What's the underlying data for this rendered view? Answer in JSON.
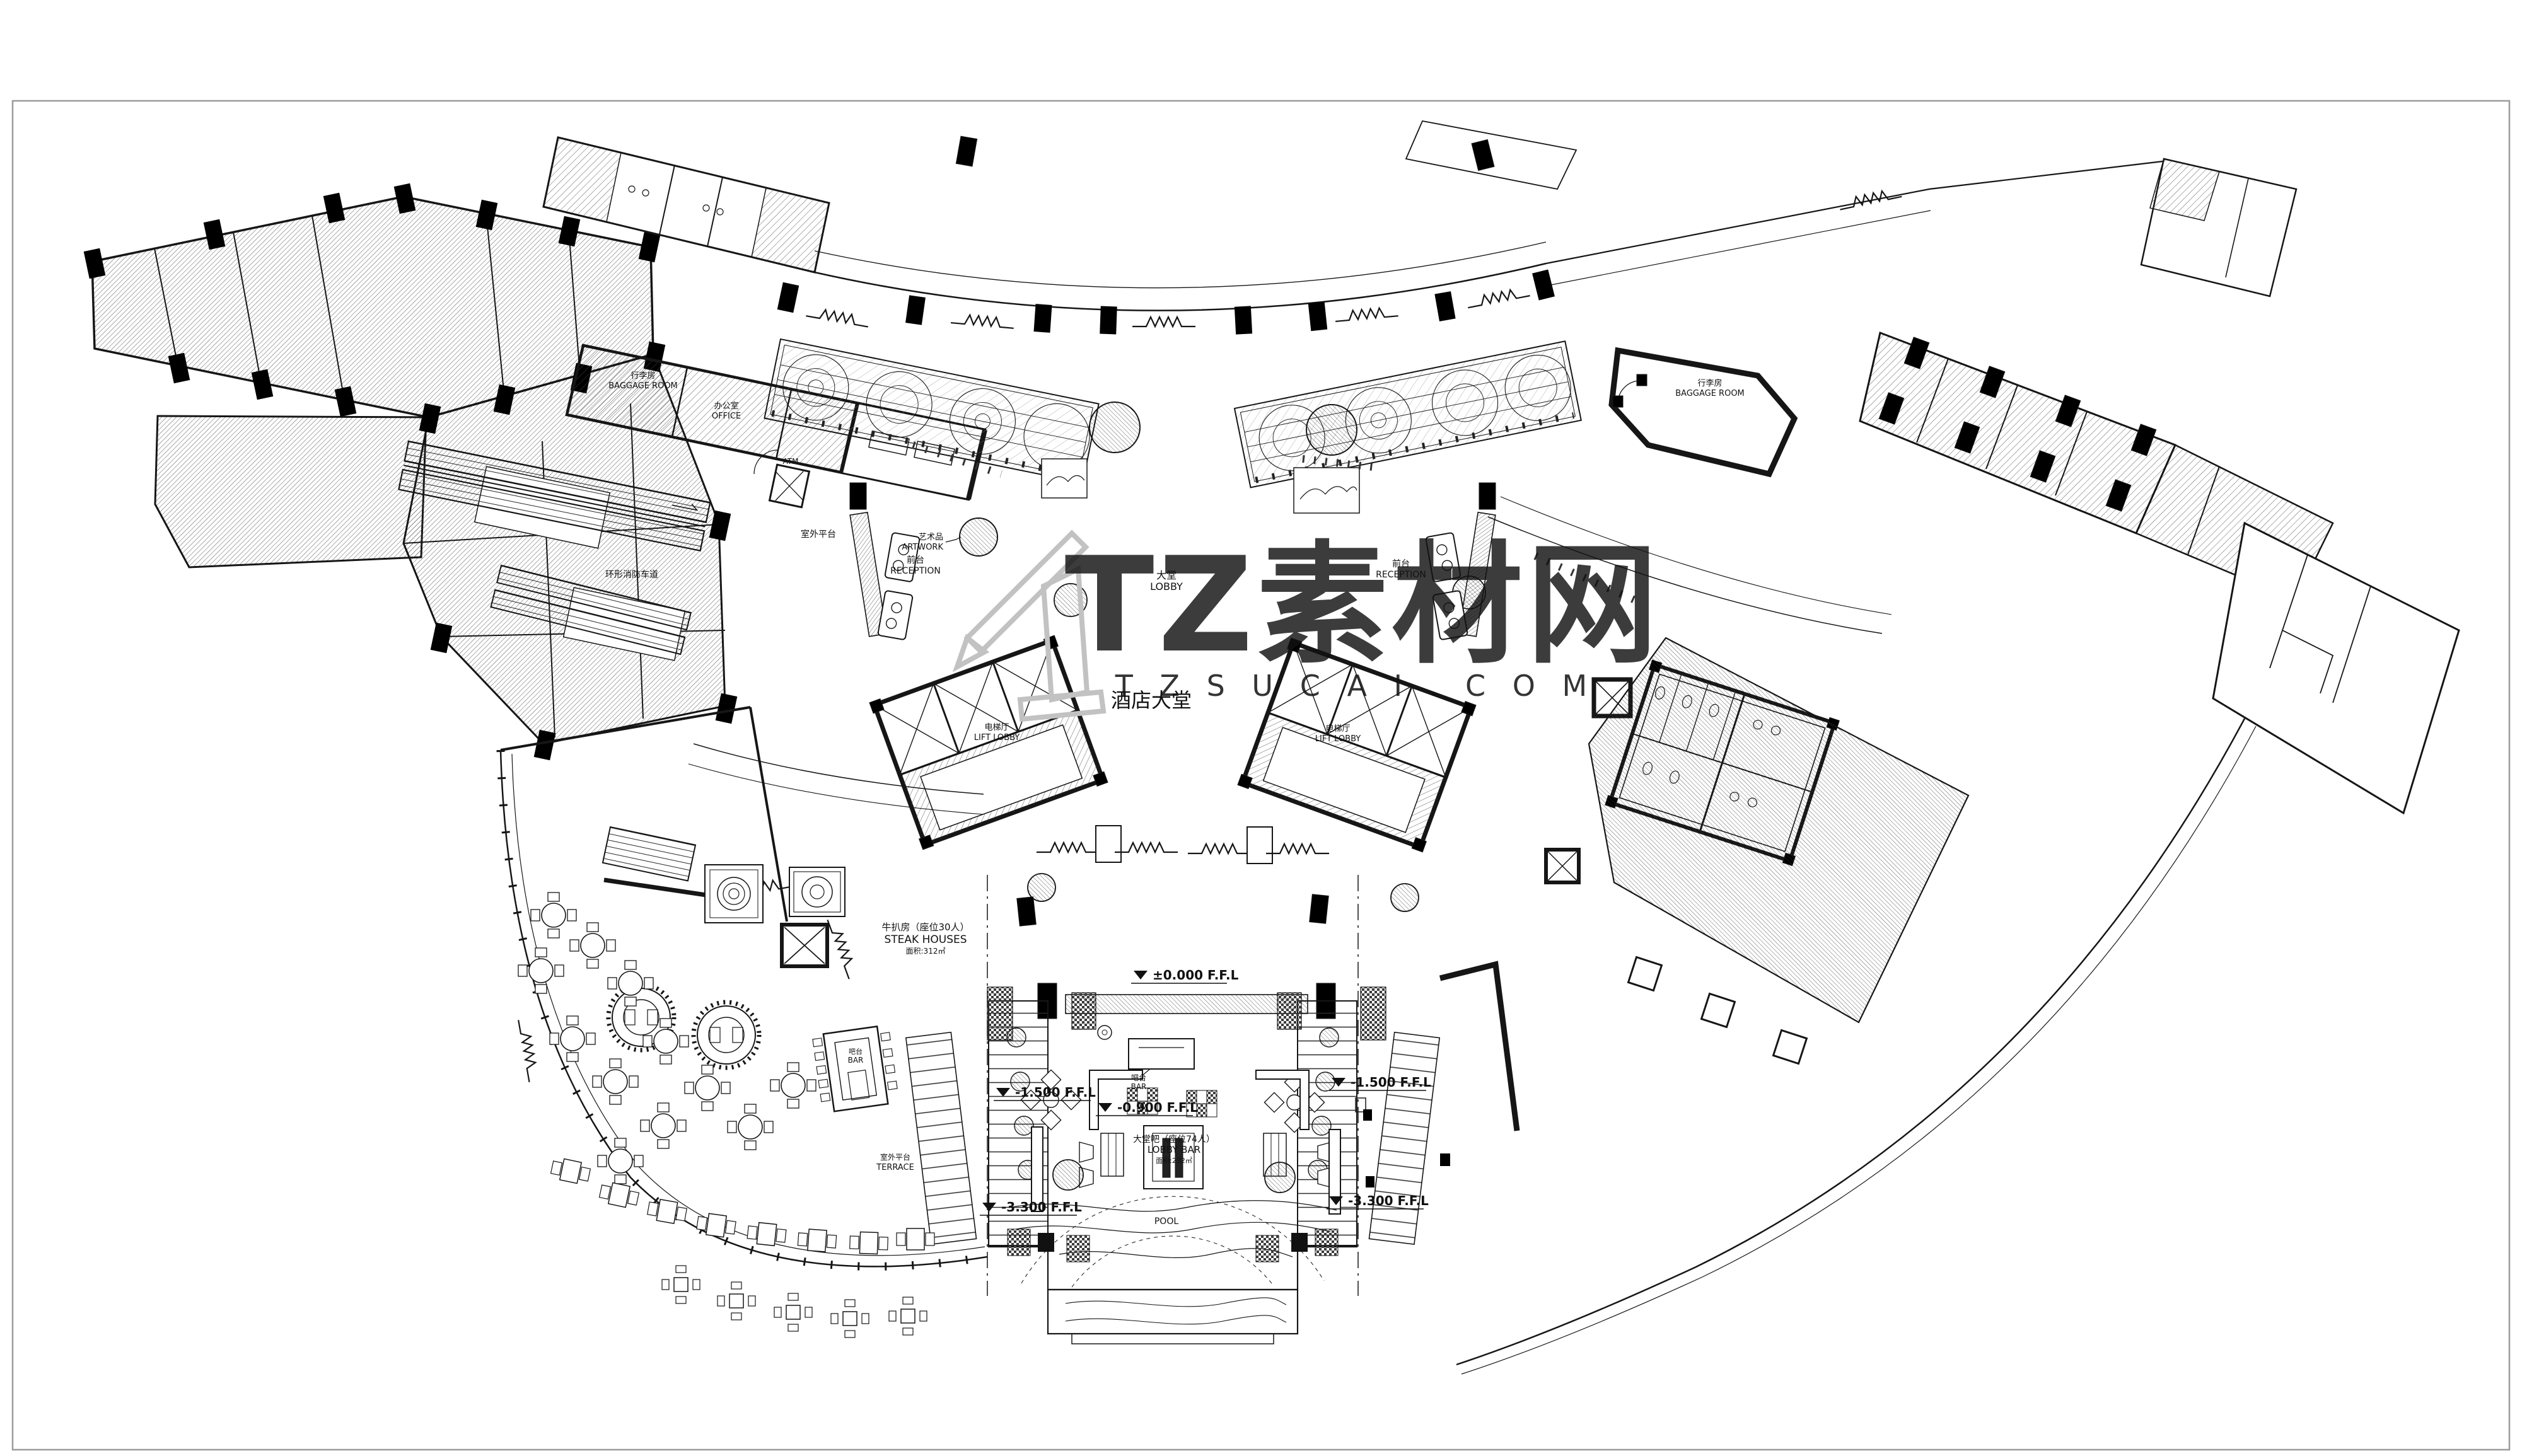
{
  "page": {
    "background": "#ffffff"
  },
  "colors": {
    "ink": "#141414",
    "wall": "#000000",
    "hatch": "#3c3c3c",
    "frame": "#9c9c9c",
    "watermark_fill": "#b5b5b5",
    "watermark_outline": "#c2c2c2"
  },
  "watermark": {
    "brand": "TZ素材网",
    "site": "T Z S U C A I . C O M"
  },
  "plan": {
    "title": "酒店大堂",
    "labels": {
      "artwork_cn": "艺术品",
      "artwork_en": "ARTWORK",
      "lobby_cn": "大堂",
      "lobby_en": "LOBBY",
      "reception_cn": "前台",
      "reception_en": "RECEPTION",
      "lift_lobby_cn": "电梯厅",
      "lift_lobby_en": "LIFT LOBBY",
      "baggage_cn": "行李房",
      "baggage_en": "BAGGAGE ROOM",
      "office_cn": "办公室",
      "office_en": "OFFICE",
      "atm": "ATM",
      "outdoor_platform": "室外平台",
      "fire_lane": "环形消防车道",
      "steak_cn": "牛扒房（座位30人）",
      "steak_en": "STEAK HOUSES",
      "steak_area": "面积:312㎡",
      "lobby_bar_cn": "大堂吧（座位74人）",
      "lobby_bar_en": "LOBBY BAR",
      "lobby_bar_area": "面积:232㎡",
      "bar_cn": "吧台",
      "bar_en": "BAR",
      "terrace_cn": "室外平台",
      "terrace_en": "TERRACE",
      "pool": "POOL"
    },
    "levels": {
      "l0": "±0.000 F.F.L",
      "l09": "-0.900 F.F.L",
      "l15": "-1.500 F.F.L",
      "l33": "-3.300 F.F.L"
    }
  }
}
